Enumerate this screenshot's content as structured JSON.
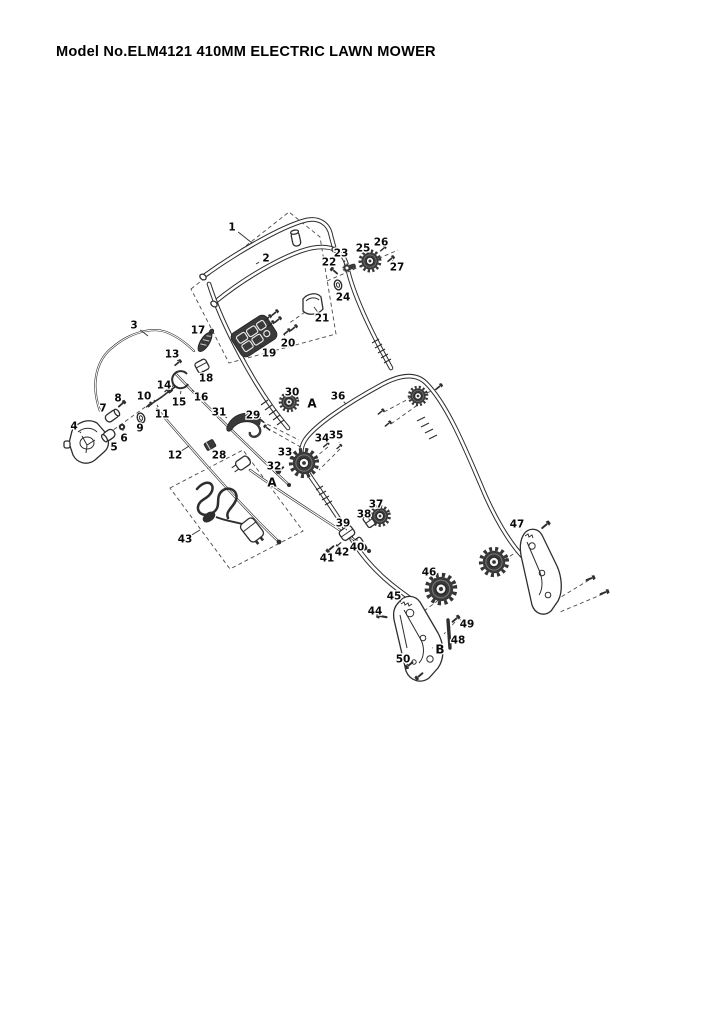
{
  "page": {
    "title": "Model No.ELM4121 410MM ELECTRIC LAWN MOWER"
  },
  "colors": {
    "background": "#ffffff",
    "line": "#2e2e2e",
    "text": "#000000"
  },
  "diagram": {
    "type": "exploded-parts-diagram",
    "callouts": [
      {
        "label": "1",
        "x": 232,
        "y": 227,
        "lx": 252,
        "ly": 243
      },
      {
        "label": "2",
        "x": 266,
        "y": 258,
        "lx": 256,
        "ly": 264
      },
      {
        "label": "3",
        "x": 134,
        "y": 325,
        "lx": 148,
        "ly": 336
      },
      {
        "label": "4",
        "x": 74,
        "y": 426,
        "lx": 81,
        "ly": 433
      },
      {
        "label": "5",
        "x": 114,
        "y": 447,
        "lx": 111,
        "ly": 440
      },
      {
        "label": "6",
        "x": 124,
        "y": 438,
        "lx": 123,
        "ly": 431
      },
      {
        "label": "7",
        "x": 103,
        "y": 408,
        "lx": 109,
        "ly": 413
      },
      {
        "label": "8",
        "x": 118,
        "y": 398,
        "lx": 122,
        "ly": 402
      },
      {
        "label": "9",
        "x": 140,
        "y": 428,
        "lx": 141,
        "ly": 422
      },
      {
        "label": "10",
        "x": 144,
        "y": 396,
        "lx": 149,
        "ly": 402
      },
      {
        "label": "11",
        "x": 162,
        "y": 414,
        "lx": 157,
        "ly": 405
      },
      {
        "label": "12",
        "x": 175,
        "y": 455,
        "lx": 189,
        "ly": 446
      },
      {
        "label": "13",
        "x": 172,
        "y": 354,
        "lx": 178,
        "ly": 361
      },
      {
        "label": "14",
        "x": 164,
        "y": 385,
        "lx": 170,
        "ly": 390
      },
      {
        "label": "15",
        "x": 179,
        "y": 402,
        "lx": 181,
        "ly": 391
      },
      {
        "label": "16",
        "x": 201,
        "y": 397,
        "lx": 192,
        "ly": 390
      },
      {
        "label": "17",
        "x": 198,
        "y": 330,
        "lx": 202,
        "ly": 337
      },
      {
        "label": "18",
        "x": 206,
        "y": 378,
        "lx": 203,
        "ly": 372
      },
      {
        "label": "19",
        "x": 269,
        "y": 353,
        "lx": 259,
        "ly": 345
      },
      {
        "label": "20",
        "x": 288,
        "y": 343,
        "lx": 284,
        "ly": 334
      },
      {
        "label": "21",
        "x": 322,
        "y": 318,
        "lx": 314,
        "ly": 307
      },
      {
        "label": "22",
        "x": 329,
        "y": 262,
        "lx": 333,
        "ly": 268
      },
      {
        "label": "23",
        "x": 341,
        "y": 253,
        "lx": 345,
        "ly": 262
      },
      {
        "label": "24",
        "x": 343,
        "y": 297,
        "lx": 339,
        "ly": 289
      },
      {
        "label": "25",
        "x": 363,
        "y": 248,
        "lx": 367,
        "ly": 254
      },
      {
        "label": "26",
        "x": 381,
        "y": 242,
        "lx": 384,
        "ly": 246
      },
      {
        "label": "27",
        "x": 397,
        "y": 267,
        "lx": 393,
        "ly": 261
      },
      {
        "label": "28",
        "x": 219,
        "y": 455,
        "lx": 213,
        "ly": 449
      },
      {
        "label": "29",
        "x": 253,
        "y": 415,
        "lx": 259,
        "ly": 419
      },
      {
        "label": "30",
        "x": 292,
        "y": 392,
        "lx": 290,
        "ly": 397
      },
      {
        "label": "31",
        "x": 219,
        "y": 412,
        "lx": 227,
        "ly": 418
      },
      {
        "label": "32",
        "x": 274,
        "y": 466,
        "lx": 278,
        "ly": 469
      },
      {
        "label": "33",
        "x": 285,
        "y": 452,
        "lx": 295,
        "ly": 458
      },
      {
        "label": "34",
        "x": 322,
        "y": 438,
        "lx": 326,
        "ly": 442
      },
      {
        "label": "35",
        "x": 336,
        "y": 435,
        "lx": 339,
        "ly": 442
      },
      {
        "label": "36",
        "x": 338,
        "y": 396,
        "lx": 346,
        "ly": 404
      },
      {
        "label": "37",
        "x": 376,
        "y": 504,
        "lx": 379,
        "ly": 509
      },
      {
        "label": "38",
        "x": 364,
        "y": 514,
        "lx": 367,
        "ly": 517
      },
      {
        "label": "39",
        "x": 343,
        "y": 523,
        "lx": 346,
        "ly": 529
      },
      {
        "label": "40",
        "x": 357,
        "y": 547,
        "lx": 357,
        "ly": 541
      },
      {
        "label": "41",
        "x": 327,
        "y": 558,
        "lx": 328,
        "ly": 553
      },
      {
        "label": "42",
        "x": 342,
        "y": 552,
        "lx": 339,
        "ly": 548
      },
      {
        "label": "43",
        "x": 185,
        "y": 539,
        "lx": 200,
        "ly": 530
      },
      {
        "label": "44",
        "x": 375,
        "y": 611,
        "lx": 378,
        "ly": 615
      },
      {
        "label": "45",
        "x": 394,
        "y": 596,
        "lx": 401,
        "ly": 602
      },
      {
        "label": "46",
        "x": 429,
        "y": 572,
        "lx": 436,
        "ly": 580
      },
      {
        "label": "47",
        "x": 517,
        "y": 524,
        "lx": 521,
        "ly": 531
      },
      {
        "label": "48",
        "x": 458,
        "y": 640,
        "lx": 452,
        "ly": 643
      },
      {
        "label": "49",
        "x": 467,
        "y": 624,
        "lx": 461,
        "ly": 620
      },
      {
        "label": "50",
        "x": 403,
        "y": 659,
        "lx": 407,
        "ly": 664
      }
    ],
    "ref_letters": [
      {
        "label": "A",
        "x": 312,
        "y": 404
      },
      {
        "label": "A",
        "x": 272,
        "y": 483
      },
      {
        "label": "B",
        "x": 440,
        "y": 650,
        "lx": 433,
        "ly": 648
      }
    ]
  }
}
